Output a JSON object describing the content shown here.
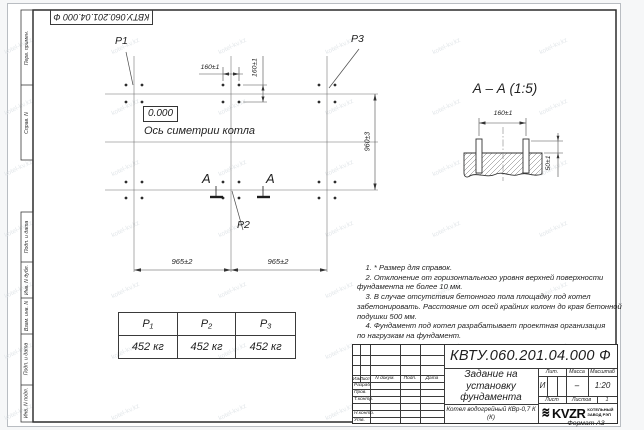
{
  "sheet": {
    "top_designation": "КВТУ.060.201.04.000 Ф",
    "format_label": "Формат А3",
    "watermark": "kotel-kv.kz"
  },
  "margin": {
    "top_labels": [
      "Перв. примен.",
      "Справ. N"
    ],
    "bottom_labels": [
      "Подп. и дата",
      "Инв. N дубл.",
      "Взам. инв. N",
      "Подп. и дата",
      "Инв. N подл."
    ]
  },
  "plan": {
    "p1": "P1",
    "p2": "P2",
    "p3": "P3",
    "elevation": "0.000",
    "symmetry_label": "Ось симетрии котла",
    "section_letter_left": "A",
    "section_letter_right": "A",
    "dim_bolt_h": "160±1",
    "dim_bolt_v": "160±1",
    "dim_span_left": "965±2",
    "dim_span_right": "965±2",
    "dim_rows": "960±3"
  },
  "section_view": {
    "title": "А – А (1:5)",
    "dim_bolts": "160±1",
    "dim_height": "50±1"
  },
  "notes": {
    "lines": [
      "    1. * Размер для справок.",
      "    2. Отклонение от горизонтального уровня верхней поверхности",
      "фундамента не более 10 мм.",
      "    3. В случае отсутствия бетонного пола площадку под котел",
      "забетонировать. Расстояние от осей крайних колонн до края бетонной",
      "подушки 500 мм.",
      "    4. Фундамент под котел разрабатывает проектная организация",
      "по нагрузкам на фундамент."
    ]
  },
  "load_table": {
    "headers": [
      "P₁",
      "P₂",
      "P₃"
    ],
    "values": [
      "452 кг",
      "452 кг",
      "452 кг"
    ]
  },
  "title_block": {
    "designation": "КВТУ.060.201.04.000  Ф",
    "doc_title": "Задание на установку фундамента",
    "product": "Котел водогрейный КВр-0,7 К (К)",
    "header_cols": [
      "Изм.",
      "Лист",
      "N докум.",
      "Подп.",
      "Дата"
    ],
    "row_labels": [
      "Разраб.",
      "Пров.",
      "Т.контр.",
      "Н.контр.",
      "Утв."
    ],
    "lit_label": "Лит.",
    "mass_label": "Масса",
    "scale_label": "Масштаб",
    "lit_value": "И",
    "mass_value": "–",
    "scale_value": "1:20",
    "sheet_label": "Лист",
    "sheets_label": "Листов",
    "sheets_value": "1",
    "logo_mark": "≋",
    "logo_text": "KVZR",
    "logo_sub1": "КОТЕЛЬНЫЙ",
    "logo_sub2": "ЗАВОД РЭП"
  }
}
